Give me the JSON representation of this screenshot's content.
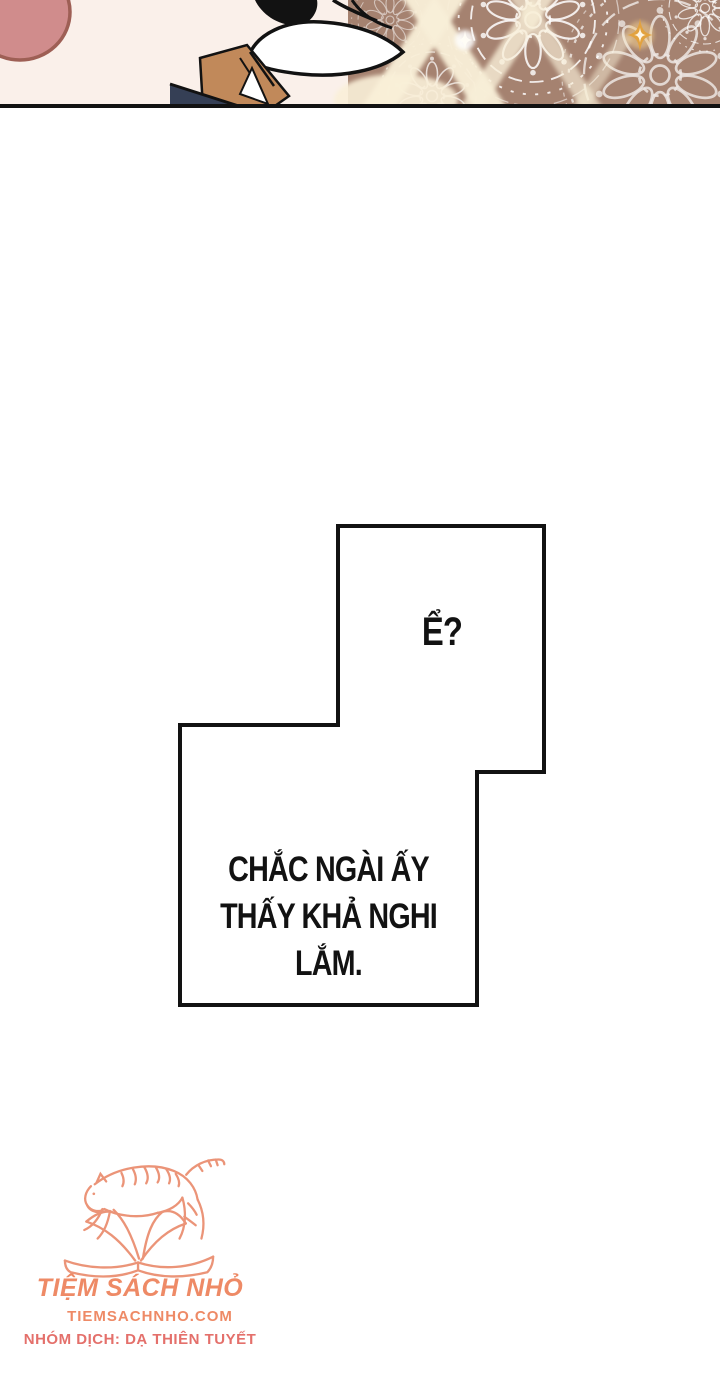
{
  "page": {
    "width": 720,
    "height": 1381,
    "background": "#ffffff"
  },
  "comic_panel": {
    "description": "cropped manhwa artwork: rose hair shape top-left, character chin/neck in profile, brown wall with white lace mandala pattern, cream light streaks and gold sparkle",
    "colors": {
      "backdrop_cream": "#faf0ea",
      "hair_rose": "#d08c8c",
      "hair_outline": "#9e5f55",
      "wall_brown": "#a58270",
      "lace_white": "#ffffff",
      "light_streak": "#f9efd8",
      "sparkle_gold": "#e2a23f",
      "skin_tan": "#c1895a",
      "outfit_navy": "#353f55",
      "ink_black": "#121212"
    }
  },
  "speech_bubbles": [
    {
      "text": "Ể?"
    },
    {
      "text": "CHẮC NGÀI ẤY THẤY KHẢ NGHI LẮM.",
      "lines": [
        "CHẮC NGÀI ẤY",
        "THẤY KHẢ NGHI",
        "LẮM."
      ]
    }
  ],
  "watermark": {
    "title": "TIỆM SÁCH NHỎ",
    "website": "TIEMSACHNHO.COM",
    "team": "NHÓM DỊCH: DẠ THIÊN TUYẾT",
    "logo_color": "#eb9478",
    "title_color": "#ee8a66",
    "team_color": "#e4706b"
  }
}
